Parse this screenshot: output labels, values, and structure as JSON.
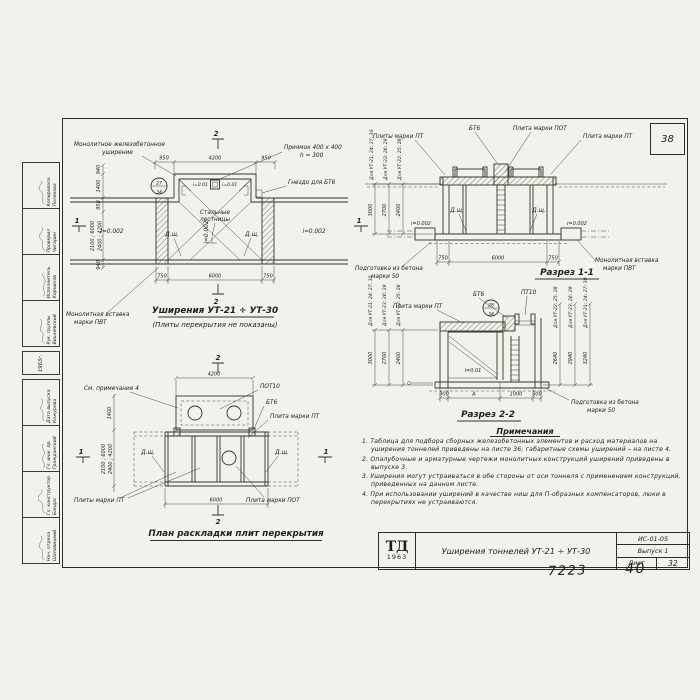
{
  "sheet": {
    "corner_number": "38",
    "handwritten_a": "7223",
    "handwritten_b": "40"
  },
  "common": {
    "drain": "Д.щ.",
    "slope002": "i=0.002",
    "slope001": "i=0.01",
    "bt6": "БТ6",
    "pt10": "ПТ10",
    "pot10": "ПОТ10",
    "plita_pt": "Плита марки ПТ",
    "plity_pt": "Плиты марки ПТ",
    "plita_pot": "Плита марки ПОТ",
    "prep1": "Подготовка из бетона",
    "prep2": "марки 50",
    "insert1": "Монолитная вставка",
    "insert2": "марки ПВТ",
    "ut_group_a": "Для УТ-21; 24; 27; 30",
    "ut_group_b": "Для УТ-23; 26; 29",
    "ut_group_c": "Для УТ-22; 25; 28",
    "mark1": "1",
    "mark2": "2"
  },
  "plan_widening": {
    "title": "Уширения  УТ-21 ÷ УТ-30",
    "subtitle": "(Плиты перекрытия не показаны)",
    "label_monolithic1": "Монолитное железобетонное",
    "label_monolithic2": "уширение",
    "label_pit1": "Приямок 400 х 400",
    "label_pit2": "h = 300",
    "label_socket": "Гнездо для БТ6",
    "label_ladders1": "Стальные",
    "label_ladders2": "лестницы",
    "bubble_top": "27",
    "bubble_bottom": "34",
    "dim_top_left": "950",
    "dim_top_mid": "4200",
    "dim_top_right": "950",
    "dim_bottom_left": "750",
    "dim_bottom_mid": "6000",
    "dim_bottom_right": "750",
    "dim_left_1": "940",
    "dim_left_2": "1400",
    "dim_left_3": "950",
    "dim_left_4": "940",
    "dim_left_rot1": "2100 ; 6000",
    "dim_left_rot2": "2400 ; 4200"
  },
  "section11": {
    "title": "Разрез 1-1",
    "heights": [
      "3000",
      "2700",
      "2400"
    ],
    "dim_left": "750",
    "dim_mid": "6000",
    "dim_right": "750"
  },
  "section22": {
    "title": "Разрез 2-2",
    "bubble_top": "28",
    "bubble_bottom": "34",
    "heights_left": [
      "3000",
      "2700",
      "2400"
    ],
    "heights_right": [
      "2640",
      "2940",
      "3240"
    ],
    "dims_bottom": [
      "300",
      "А",
      "1000",
      "300"
    ]
  },
  "plan_slabs": {
    "title": "План раскладки плит перекрытия",
    "see_note": "См. примечание 4",
    "dim_top": "4200",
    "dim_bottom": "6000",
    "dim_left": "1400",
    "dim_left_rot1": "2100 ; 6000",
    "dim_left_rot2": "2400 ; 4200"
  },
  "notes": {
    "title": "Примечания",
    "items": [
      "1. Таблица для подбора сборных железобетонных элементов и расход материалов на уширения тоннелей приведены на листе 36; габаритные схемы уширений – на листе 4.",
      "2. Опалубочные и арматурные чертежи монолитных конструкций уширений приведены в выпуске 3.",
      "3. Уширения могут устраиваться в обе стороны от оси тоннеля с применением конструкций, приведенных на данном листе.",
      "4. При использовании уширений в качестве ниш для П-образных компенсаторов, люки в перекрытиях не устраиваются."
    ]
  },
  "titleblock": {
    "logo_top": "ТД",
    "logo_year": "1963",
    "title": "Уширения тоннелей УТ-21 ÷ УТ-30",
    "code": "ИС-01-05",
    "issue": "Выпуск 1",
    "sheet_label": "Лист",
    "sheet_number": "32"
  },
  "stamp": {
    "year": "1963г.",
    "rows_a": [
      {
        "role": "Рук. группы",
        "name": "Вишневский"
      },
      {
        "role": "Исполнитель",
        "name": "Корнилов"
      },
      {
        "role": "Проверил",
        "name": "Чигарин"
      },
      {
        "role": "Копировала",
        "name": "Полякова"
      }
    ],
    "rows_b": [
      {
        "role": "Нач. отдела",
        "name": "Шаповицкий"
      },
      {
        "role": "Гл. конструктор",
        "name": "Бандас"
      },
      {
        "role": "Гл. инж. пр.",
        "name": "Гражданский"
      },
      {
        "role": "Дата выпуска",
        "name": "Кожурова"
      }
    ]
  }
}
